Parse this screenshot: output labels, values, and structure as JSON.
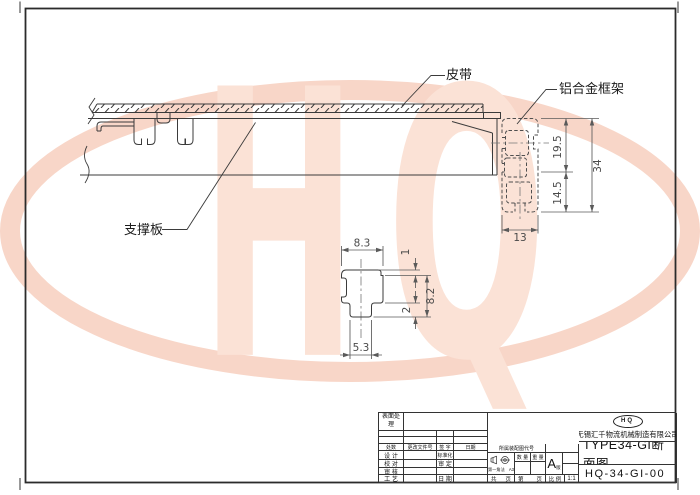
{
  "watermark": {
    "text": "HQ"
  },
  "callouts": {
    "belt": "皮带",
    "frame": "铝合金框架",
    "plate": "支撑板"
  },
  "dims": {
    "upper": "19.5",
    "total": "34",
    "lower": "14.5",
    "width": "13",
    "top_w": "8.3",
    "lip": "1",
    "height": "8.2",
    "flange": "2",
    "bottom_w": "5.3"
  },
  "tb": {
    "surface": "表面处理",
    "chg_qty": "处数",
    "chg_doc": "更改文件号",
    "chg_sign": "签 字",
    "chg_date": "日期",
    "r1l": "设 计",
    "r1r": "标准化",
    "r2l": "校 对",
    "r2r": "审 定",
    "r3l": "审 核",
    "r3r": "",
    "r4l": "工 艺",
    "r4r": "日 期",
    "assembly": "所属装配图代号",
    "qty": "数 量",
    "weight": "重 量",
    "projection": "第一角法",
    "sheet": "A3",
    "rev": "A",
    "rev_word": "版",
    "total_word": "共",
    "page_word": "页",
    "ordinal_word": "第",
    "page_word2": "页",
    "scale_label": "比 例",
    "scale": "1:1",
    "logo": "HQ",
    "company": "无锡汇千物流机械制造有限公司",
    "title": "TYPE34-GI断面图",
    "number": "HQ-34-GI-00"
  }
}
